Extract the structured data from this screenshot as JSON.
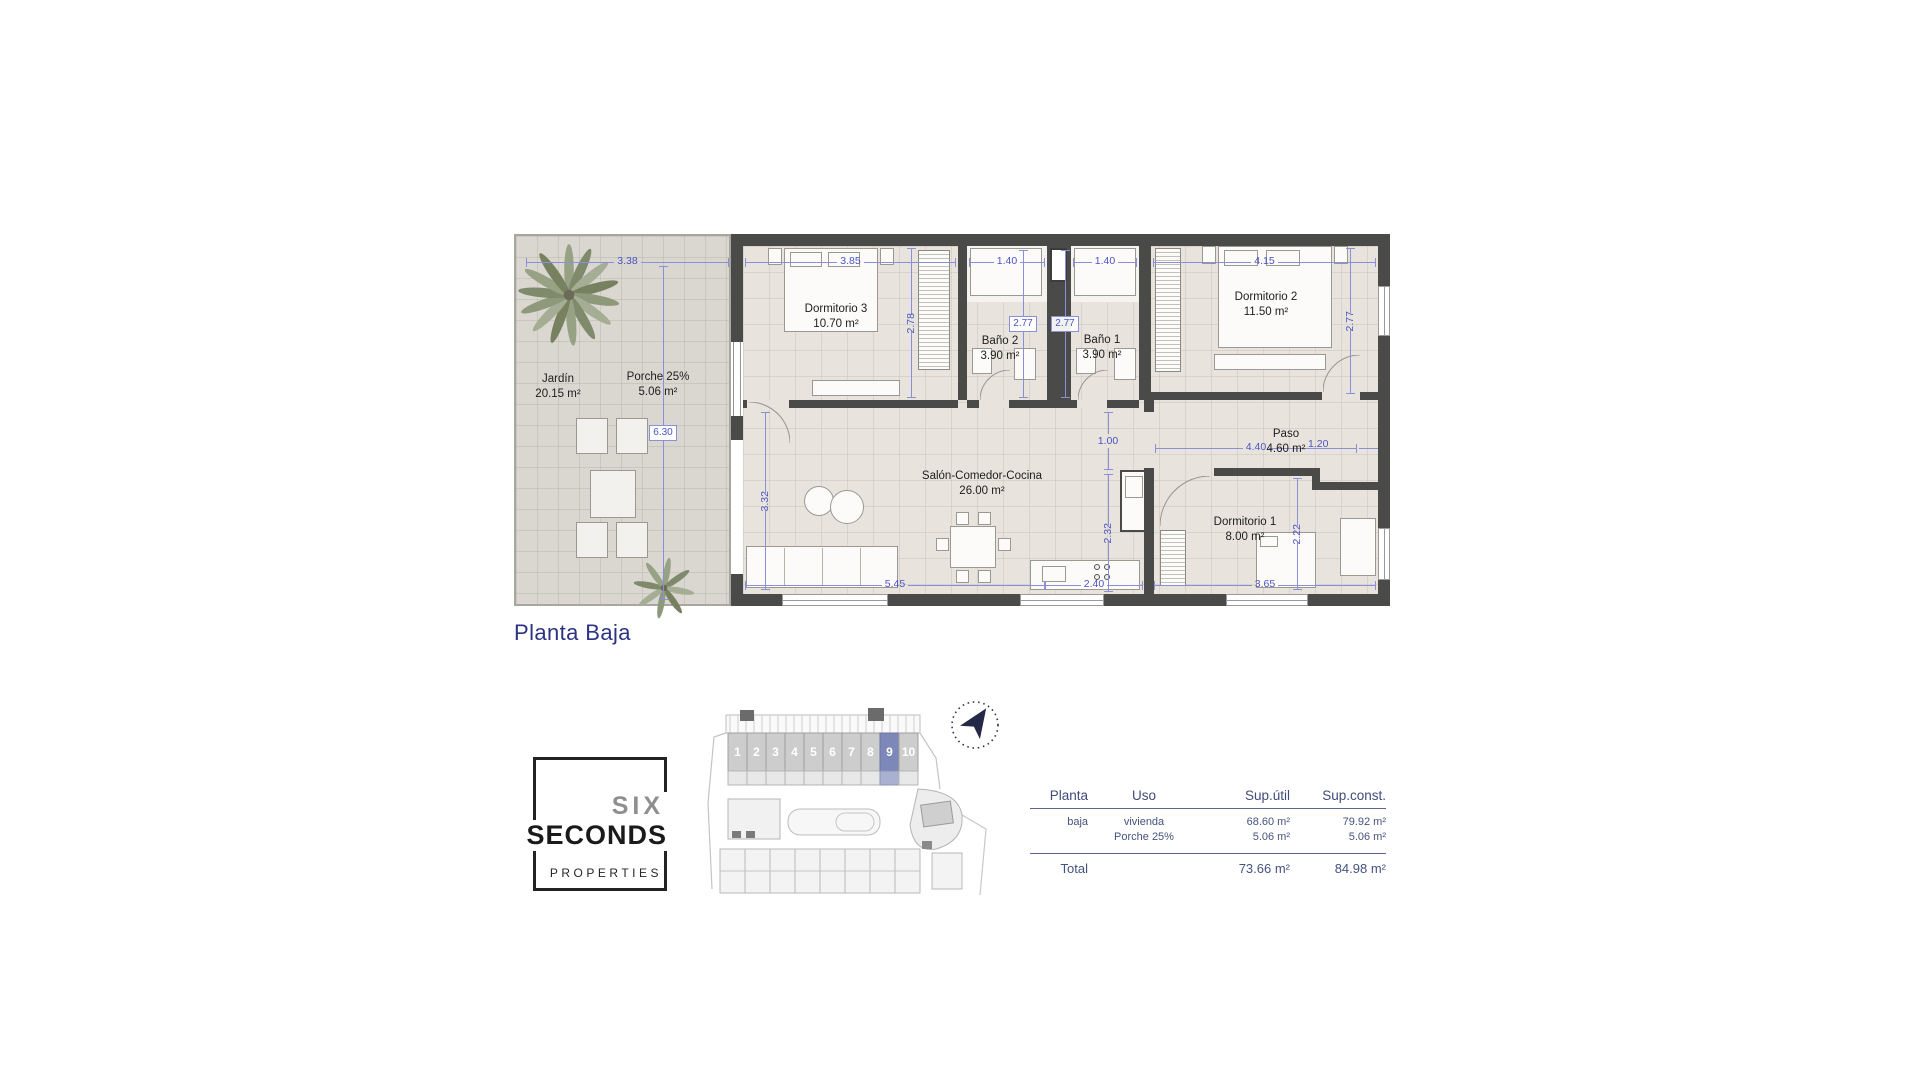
{
  "floor_plan": {
    "title": "Planta Baja",
    "rooms": [
      {
        "name": "Jardín",
        "area": "20.15 m²"
      },
      {
        "name": "Porche 25%",
        "area": "5.06 m²"
      },
      {
        "name": "Dormitorio 3",
        "area": "10.70 m²"
      },
      {
        "name": "Baño 2",
        "area": "3.90 m²"
      },
      {
        "name": "Baño 1",
        "area": "3.90 m²"
      },
      {
        "name": "Dormitorio 2",
        "area": "11.50 m²"
      },
      {
        "name": "Salón-Comedor-Cocina",
        "area": "26.00 m²"
      },
      {
        "name": "Paso",
        "area": "4.60 m²"
      },
      {
        "name": "Dormitorio 1",
        "area": "8.00 m²"
      }
    ],
    "dims": {
      "terrace_top": "3.38",
      "dorm3_top": "3.85",
      "bano2_top": "1.40",
      "bano1_top": "1.40",
      "dorm2_top": "4.15",
      "dorm3_side": "2.78",
      "bano2_box": "2.77",
      "bano1_box": "2.77",
      "dorm2_side": "2.77",
      "terrace_side": "6.30",
      "salon_side": "3.32",
      "paso_opening": "1.00",
      "kitchen_side": "2.32",
      "dorm1_side": "2.22",
      "paso_top": "4.40",
      "dorm2_door": "1.20",
      "salon_bottom": "5.45",
      "kitchen_bottom": "2.40",
      "dorm1_bottom": "3.65"
    }
  },
  "logo": {
    "line1": "SIX",
    "line2": "SECONDS",
    "line3": "PROPERTIES"
  },
  "site_plan": {
    "units": [
      "1",
      "2",
      "3",
      "4",
      "5",
      "6",
      "7",
      "8",
      "9",
      "10"
    ],
    "highlighted_unit": "9"
  },
  "table": {
    "headers": [
      "Planta",
      "Uso",
      "Sup.útil",
      "Sup.const."
    ],
    "rows": [
      {
        "planta": "baja",
        "uso": "vivienda",
        "sup_util": "68.60 m²",
        "sup_const": "79.92 m²"
      },
      {
        "planta": "",
        "uso": "Porche 25%",
        "sup_util": "5.06 m²",
        "sup_const": "5.06 m²"
      }
    ],
    "total": {
      "label": "Total",
      "sup_util": "73.66 m²",
      "sup_const": "84.98 m²"
    }
  },
  "colors": {
    "title_blue": "#2d3382",
    "dimension_blue": "#4a54c4",
    "wall_gray": "#4a4a49",
    "highlighted_unit_blue": "#7e88b8",
    "table_slate": "#46527e"
  }
}
